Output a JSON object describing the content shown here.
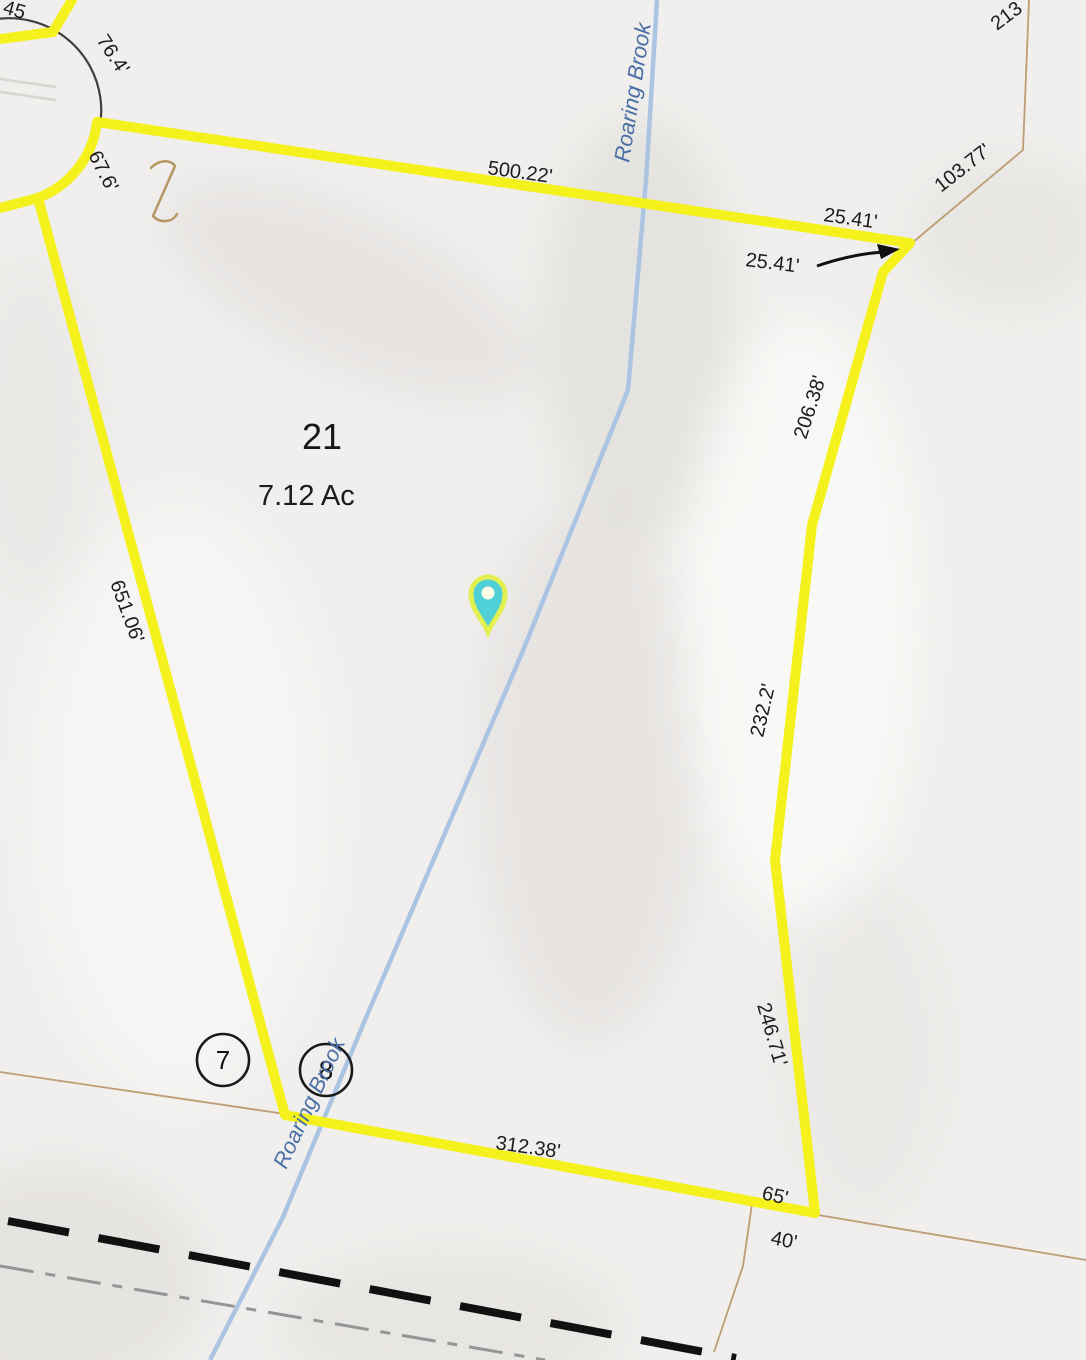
{
  "map": {
    "type": "parcel-map",
    "parcel": {
      "lot_number": "21",
      "area": "7.12 Ac"
    },
    "waterway": {
      "name": "Roaring Brook"
    },
    "road_markers": {
      "marker_a": "7",
      "marker_b": "8"
    },
    "dimension_labels": {
      "top_edge": "500.22'",
      "jog_offset": "25.41'",
      "jog_callout": "25.41'",
      "neighbor_ne_diag": "103.77'",
      "neighbor_ne_partial": "213",
      "culdesac_arc_upper": "76.4'",
      "culdesac_arc_lower": "67.6'",
      "west_edge": "651.06'",
      "east_upper": "206.38'",
      "east_middle": "232.2'",
      "east_lower": "246.71'",
      "corner_65": "65'",
      "corner_40": "40'",
      "south_edge": "312.38'",
      "nw_partial": "45"
    },
    "colors": {
      "parcel_outline": "#F5F11C",
      "neighbor_line": "#BD9E72",
      "brook_line": "#AAC4E2",
      "brook_text": "#4A6FA5",
      "label_text": "#1C1C1C",
      "road_dash": "#111111",
      "road_dashdot": "#959595",
      "pin_fill": "#4FD0D6",
      "pin_ring": "#E3F052",
      "background": "#F0EFED"
    }
  }
}
